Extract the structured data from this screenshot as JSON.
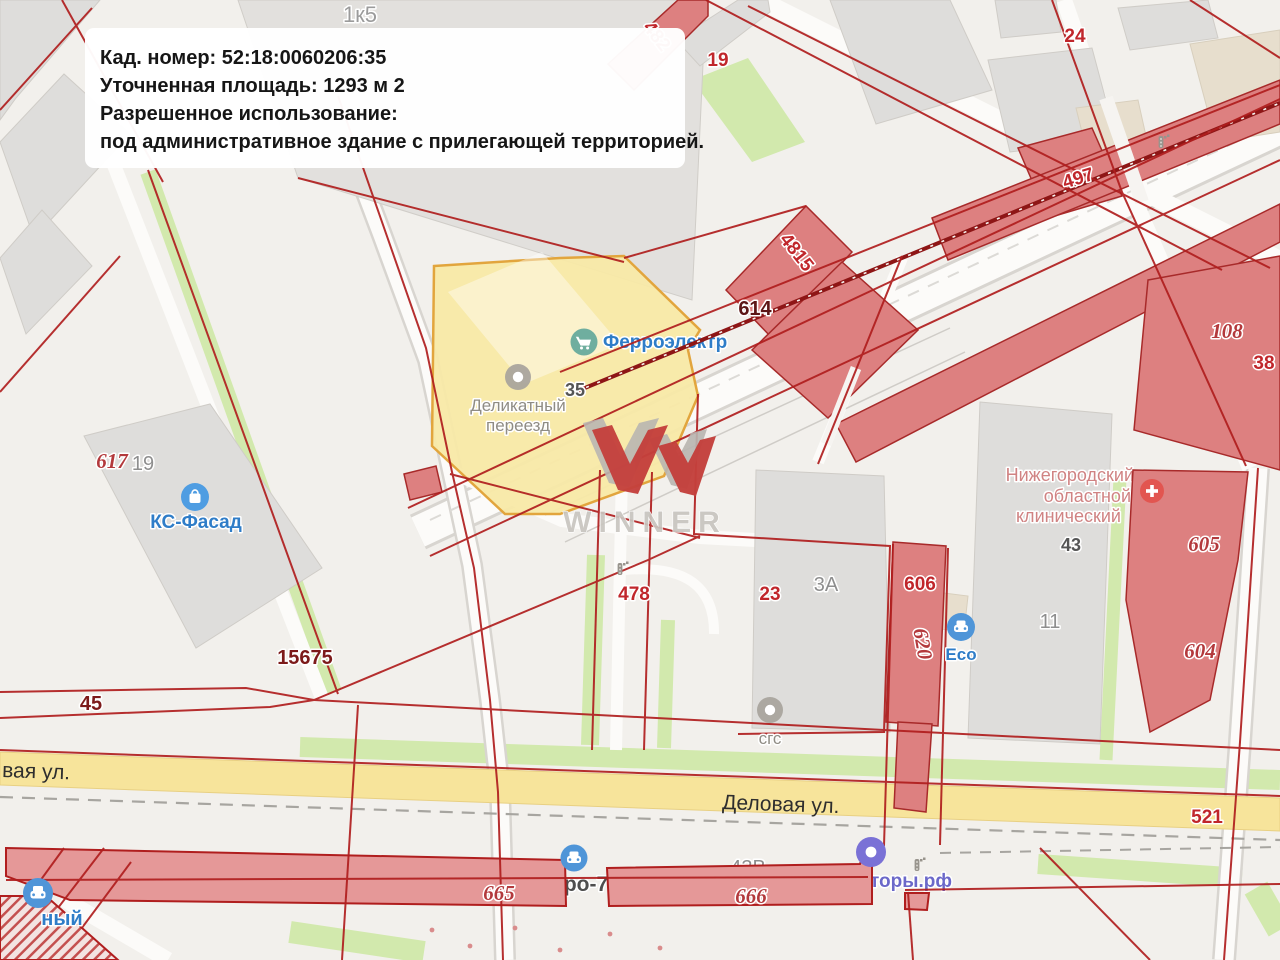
{
  "info_box": {
    "lines": [
      "Кад. номер: 52:18:0060206:35",
      "Уточненная площадь: 1293 м 2",
      "Разрешенное использование:",
      "под административное здание с прилегающей территорией."
    ]
  },
  "watermark": {
    "brand": "WINNER"
  },
  "streets": {
    "delovaya": "Деловая ул.",
    "delovaya_partial": "вая ул."
  },
  "pois": {
    "delikatny_line1": "Деликатный",
    "delikatny_line2": "переезд",
    "ferro": "Ферроэлектр",
    "ks_fasad": "КС-Фасад",
    "hospital_line1": "Нижегородский",
    "hospital_line2": "областной",
    "hospital_line3": "клинический",
    "eco": "Eco",
    "sgs": "сгс",
    "bottom_left_partial": "ный",
    "site_partial": "торы.рф",
    "auto_partial": "ро-7"
  },
  "parcel_numbers": {
    "n482": "482",
    "n19_top": "19",
    "n24": "24",
    "n497": "497",
    "n4815": "4815",
    "n614": "614",
    "n108": "108",
    "n38": "38",
    "n617": "617",
    "n606": "606",
    "n620": "620",
    "n23": "23",
    "n478": "478",
    "n15675": "15675",
    "n45": "45",
    "n521": "521",
    "n665": "665",
    "n666": "666",
    "n605": "605",
    "n604": "604"
  },
  "building_numbers": {
    "n1k5": "1к5",
    "n19_gray": "19",
    "n3a": "3А",
    "n11": "11",
    "n43": "43",
    "n35": "35",
    "n43v": "43В"
  },
  "colors": {
    "selected_parcel_fill": "#f8e9a6",
    "selected_parcel_border": "#e2a53d",
    "cadastral_line": "#b01e1e",
    "building_pink": "#dd8080",
    "building_gray": "#dedddb",
    "road_yellow": "#f7e49b",
    "poi_blue": "#2f7dc8",
    "hospital_red": "#e25550",
    "brand_red": "#c4403c"
  }
}
